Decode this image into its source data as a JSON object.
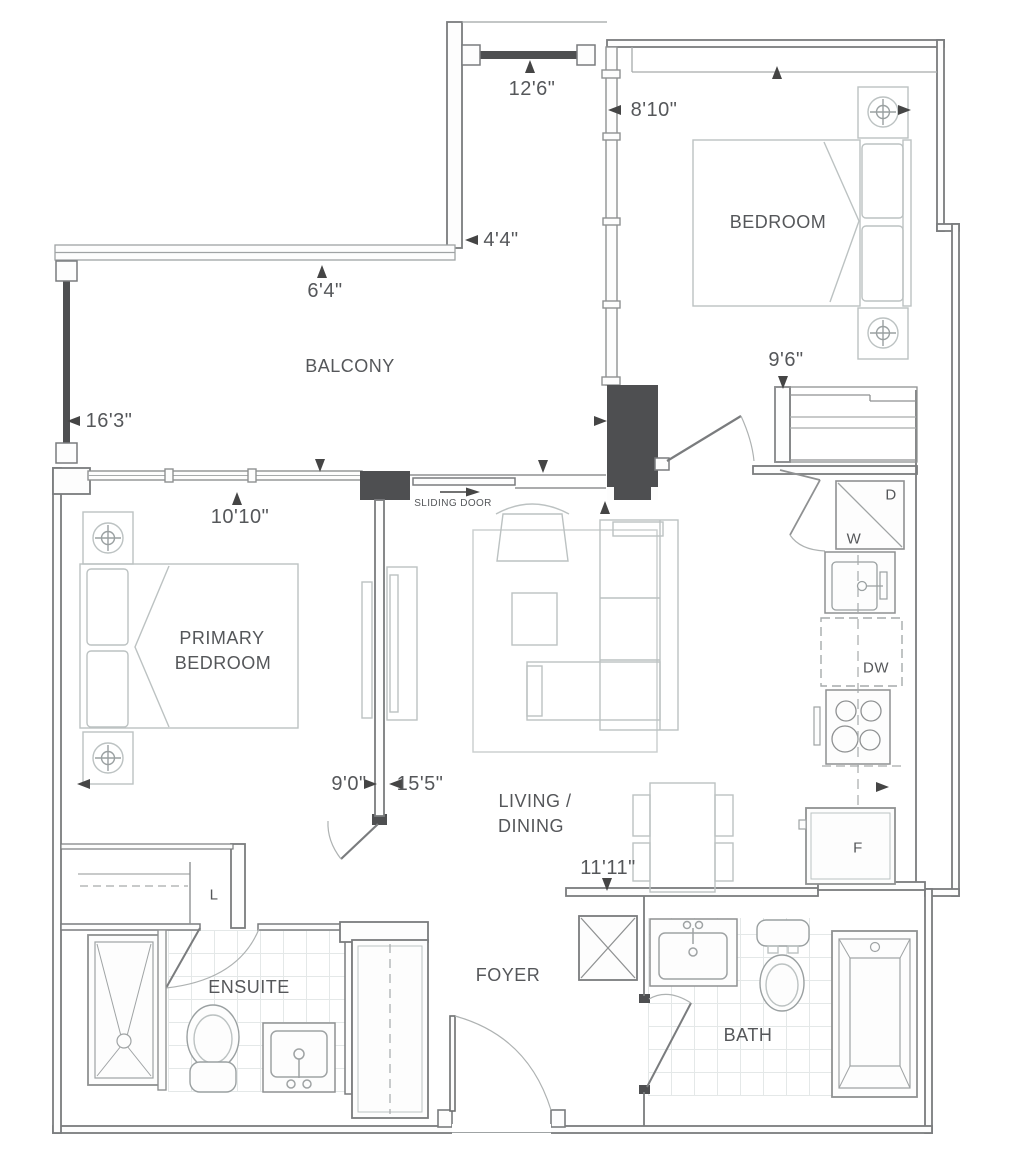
{
  "plan": {
    "rooms": {
      "balcony": "BALCONY",
      "bedroom": "BEDROOM",
      "primary_line1": "PRIMARY",
      "primary_line2": "BEDROOM",
      "living_line1": "LIVING /",
      "living_line2": "DINING",
      "foyer": "FOYER",
      "ensuite": "ENSUITE",
      "bath": "BATH"
    },
    "dimensions": {
      "balcony_top": "12'6\"",
      "bedroom_width": "8'10\"",
      "balcony_corner": "4'4\"",
      "balcony_depth": "6'4\"",
      "balcony_rail": "16'3\"",
      "bedroom_length": "9'6\"",
      "primary_window": "10'10\"",
      "primary_width": "9'0\"",
      "living_width": "15'5\"",
      "living_length": "11'11\""
    },
    "appliances": {
      "washer": "W",
      "dryer": "D",
      "dishwasher": "DW",
      "fridge": "F",
      "linen": "L"
    },
    "annotations": {
      "sliding_door": "SLIDING DOOR"
    },
    "colors": {
      "wall": "#7a7c7e",
      "dark_fill": "#4e4f51",
      "text": "#55575a",
      "furniture": "#bcc2c2",
      "tile": "#e4e8e8"
    }
  }
}
